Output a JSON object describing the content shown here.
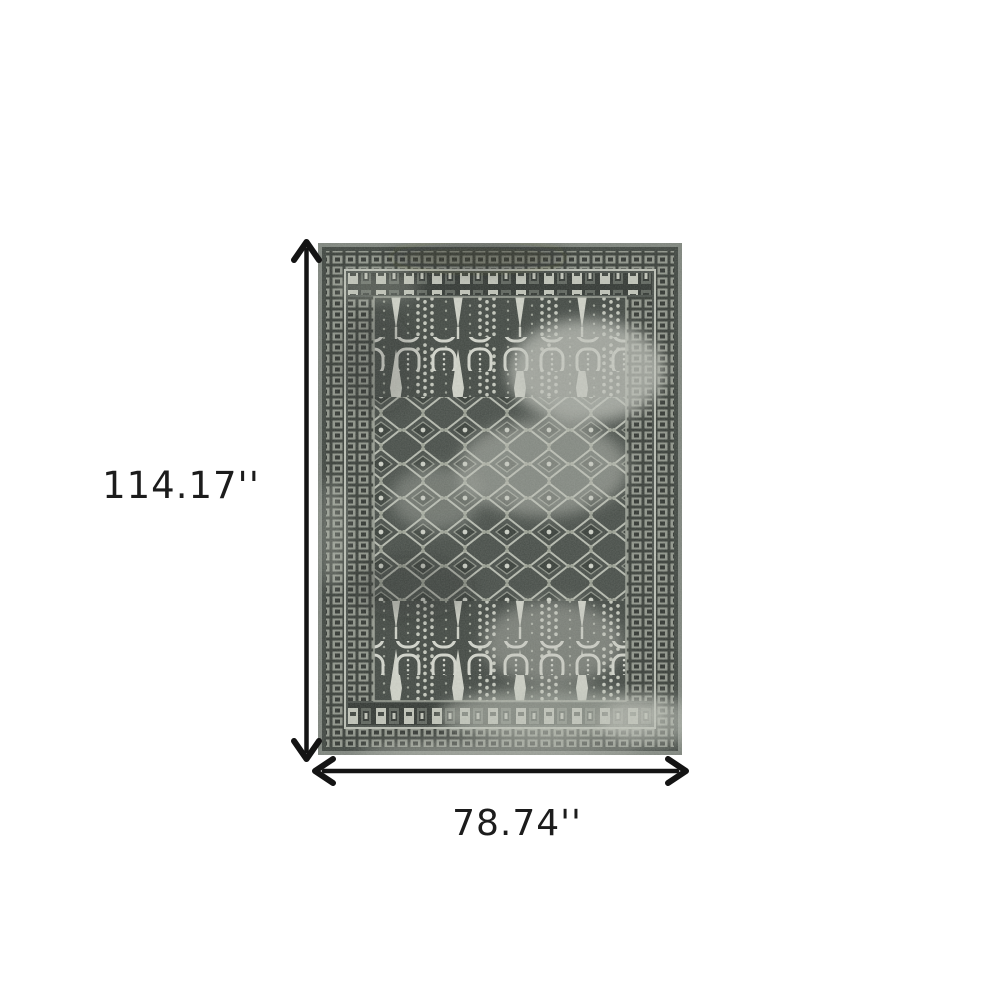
{
  "diagram": {
    "type": "product-dimension-diagram",
    "product_description": "Distressed charcoal grey oriental area rug with cypress-column panels, diamond lattice field and faded patches",
    "height_label": "114.17''",
    "width_label": "78.74''"
  },
  "icons": {
    "height_arrow": "double-headed-vertical-arrow",
    "width_arrow": "double-headed-horizontal-arrow"
  },
  "colors": {
    "background": "#ffffff",
    "arrow": "#141414",
    "label_text": "#1c1c1c",
    "rug_fringe": "#7e847d",
    "rug_border_dark": "#343a35",
    "rug_field_mid": "#474d48",
    "rug_motif_light": "#c6c9be",
    "rug_ivory": "#d2d4ca"
  }
}
